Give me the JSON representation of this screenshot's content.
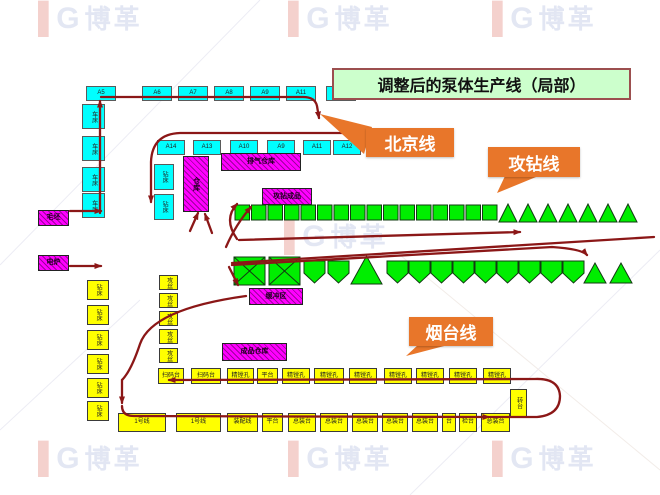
{
  "watermark": {
    "logo_text": "博革"
  },
  "title": "调整后的泵体生产线（局部）",
  "callouts": {
    "beijing": "北京线",
    "drill": "攻钻线",
    "yantai": "烟台线"
  },
  "colors": {
    "machine_cyan": "#00ffff",
    "flow_green": "#00ee00",
    "storage_magenta": "#ff00ff",
    "station_yellow": "#ffff00",
    "callout_orange": "#e8762a",
    "arrow_red": "#8b1717",
    "title_bg": "#ccffcc"
  },
  "machines": {
    "cyan_row1": [
      "A5",
      "A6",
      "A7",
      "A8",
      "A9",
      "A11",
      "A12"
    ],
    "cyan_row2": [
      "A14",
      "A13",
      "A10",
      "A9",
      "A11",
      "A12"
    ],
    "cyan_left_col": [
      "车床",
      "车床",
      "车床",
      "车床"
    ],
    "cyan_mid_col": [
      "钻床",
      "钻床"
    ]
  },
  "storage": {
    "rack_vertical": "仓库",
    "exhaust_store": "排气仓库",
    "drill_products": "攻钻成品",
    "buffer": "缓冲区",
    "finished_store": "成品仓库",
    "blank_store": "毛坯",
    "furnace": "电炉"
  },
  "flow_counts": {
    "row1_squares": 16,
    "row1_triangles": 7,
    "row2_cross_squares": 2,
    "row2_pentagons_front": 2,
    "row2_big_triangle": 1,
    "row2_pentagons_back": 9,
    "row2_end_triangles": 2
  },
  "stations": {
    "yellow_left_col": [
      "钻床",
      "钻床",
      "钻床",
      "钻床",
      "钻床",
      "钻床"
    ],
    "yellow_inner_col": [
      "攻丝",
      "攻丝",
      "攻丝",
      "攻丝",
      "攻丝"
    ],
    "row_top": [
      "扫码台",
      "扫码台",
      "精镗孔",
      "平台",
      "精镗孔",
      "精镗孔",
      "精镗孔",
      "精镗孔",
      "精镗孔",
      "精镗孔",
      "精镗孔"
    ],
    "turn_station": "转台",
    "row_bottom": [
      "1号线",
      "1号线",
      "装配线",
      "平台",
      "总装台",
      "总装台",
      "总装台",
      "总装台",
      "总装台",
      "台",
      "检台",
      "总装台"
    ]
  }
}
